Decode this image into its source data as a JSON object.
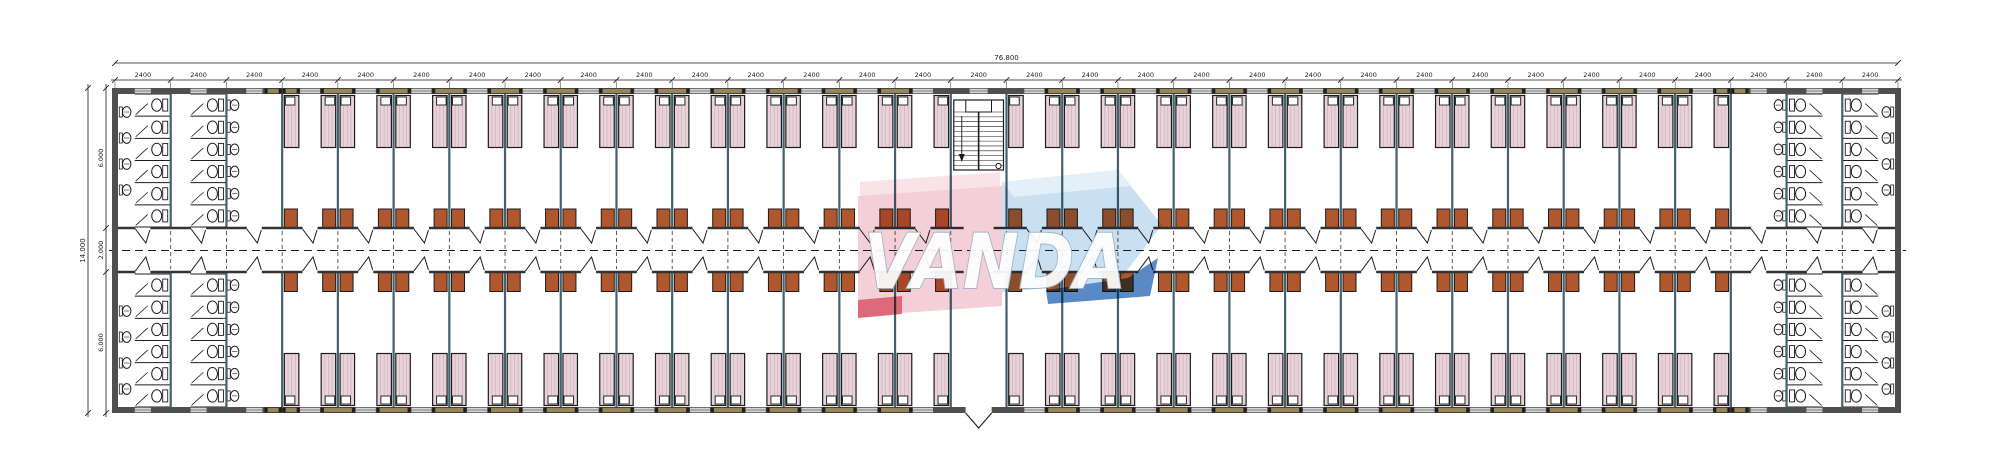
{
  "drawing": {
    "type": "dormitory-floor-plan",
    "watermark": {
      "text": "VANDA"
    },
    "dimensions": {
      "top_total": "76.800",
      "top_bays": [
        "2400",
        "2400",
        "2400",
        "2400",
        "2400",
        "2400",
        "2400",
        "2400",
        "2400",
        "2400",
        "2400",
        "2400",
        "2400",
        "2400",
        "2400",
        "2400",
        "2400",
        "2400",
        "2400",
        "2400",
        "2400",
        "2400",
        "2400",
        "2400",
        "2400",
        "2400",
        "2400",
        "2400",
        "2400",
        "2400",
        "2400",
        "2400"
      ],
      "left_total": "14.000",
      "left_segments": [
        "6.000",
        "2.000",
        "6.000"
      ]
    },
    "structure": {
      "bays": 32,
      "rooms": 50,
      "beds_per_room": 2,
      "staircases": 1,
      "entrances": 1,
      "toilet_stall_columns": 8,
      "stalls_per_column": 6,
      "washbasin_columns": 4,
      "basins_per_column": 6,
      "outer_wall_basins": 16
    },
    "colors": {
      "background": "#ffffff",
      "wall_dark": "#4f4f4f",
      "partition": "#44616c",
      "line": "#1c1c1c",
      "corridor_line": "#333333",
      "bed_fill": "#e9d3da",
      "bed_stripe": "#c9a9b3",
      "pillow_fill": "#ffffff",
      "wardrobe_fill": "#b0572e",
      "window_tan": "#97855a",
      "fixture_fill": "#ffffff",
      "wm_pink": "#f2c3cf",
      "wm_pink_light": "#f8dce4",
      "wm_red": "#d5455a",
      "wm_blue_light": "#bcd8f0",
      "wm_blue_pale": "#dcebf8",
      "wm_blue_dark": "#2f6db8",
      "wm_letters": "#ffffff",
      "wm_letter_outline": "#9fb2c4"
    }
  }
}
